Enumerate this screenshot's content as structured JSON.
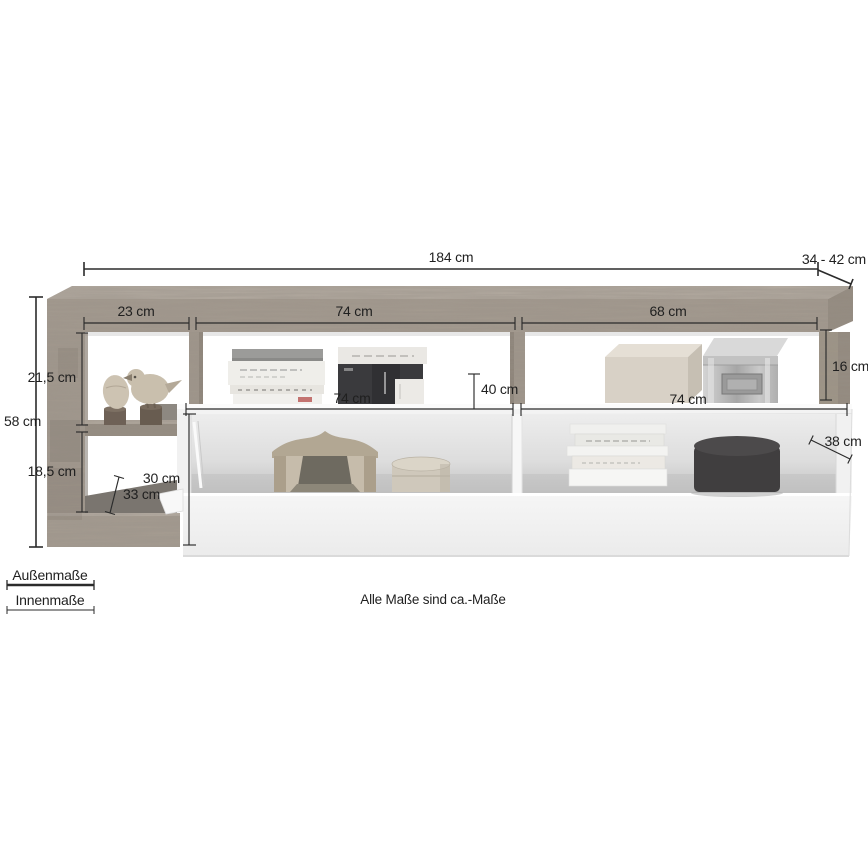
{
  "colors": {
    "wood": "#a89e92",
    "wood_light": "#b9b0a5",
    "wood_dark": "#8e8478",
    "dimension_line": "#2b2b2b",
    "body_white": "#f2f2f2"
  },
  "dims": {
    "total_width": "184 cm",
    "depth": "34 - 42 cm",
    "height": "58 cm",
    "left_width": "23 cm",
    "top_mid_width": "74 cm",
    "top_right_width": "68 cm",
    "left_top_height": "21,5 cm",
    "left_bottom_height": "18,5 cm",
    "left_depth": "33 cm",
    "shelf_depth": "40 cm",
    "right_inner_height": "16 cm",
    "bottom_left_width": "74 cm",
    "bottom_right_width": "74 cm",
    "bottom_inner_height": "30 cm",
    "bottom_depth": "38 cm"
  },
  "legend": {
    "outer_label": "Außenmaße",
    "inner_label": "Innenmaße"
  },
  "note": "Alle Maße sind ca.-Maße"
}
